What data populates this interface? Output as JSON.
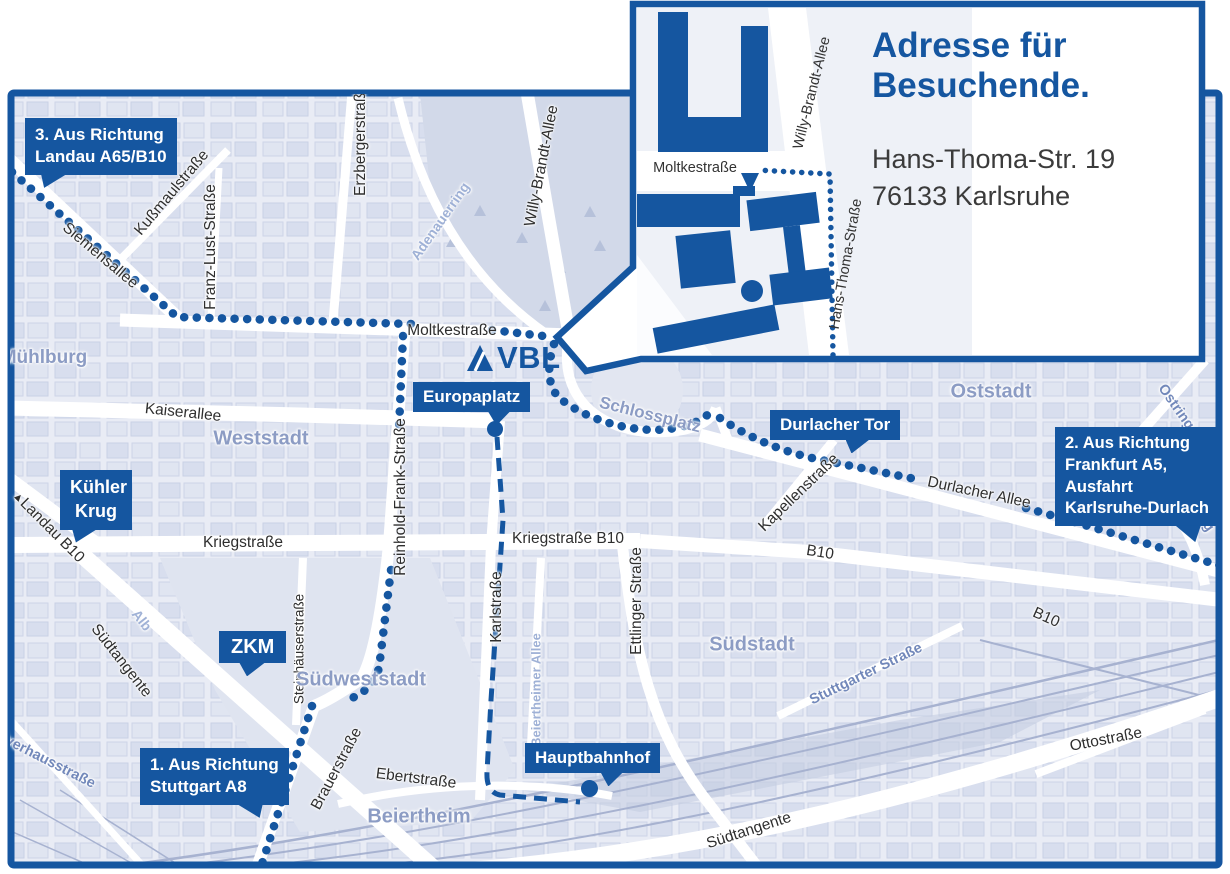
{
  "colors": {
    "brand_blue": "#1556a0",
    "map_base": "#e9ecf5",
    "area_label": "#8c9cc4",
    "water_label": "#9fb1d6"
  },
  "logo": {
    "name": "VBL"
  },
  "inset": {
    "heading_line1": "Adresse für",
    "heading_line2": "Besuchende.",
    "address_line1": "Hans-Thoma-Str. 19",
    "address_line2": "76133 Karlsruhe",
    "streets": {
      "moltkestrasse": "Moltkestraße",
      "willy_brandt_allee": "Willy-Brandt-Allee",
      "hans_thoma_strasse": "Hans-Thoma-Straße"
    }
  },
  "callouts": {
    "landau": {
      "line1": "3. Aus Richtung",
      "line2": "Landau A65/B10"
    },
    "frankfurt": {
      "line1": "2. Aus Richtung",
      "line2": "Frankfurt A5,",
      "line3": "Ausfahrt",
      "line4": "Karlsruhe-Durlach"
    },
    "stuttgart": {
      "line1": "1. Aus Richtung",
      "line2": "Stuttgart A8"
    },
    "kuehler_krug": {
      "line1": "Kühler",
      "line2": "Krug"
    },
    "zkm": {
      "label": "ZKM"
    },
    "europaplatz": {
      "label": "Europaplatz"
    },
    "durlacher_tor": {
      "label": "Durlacher Tor"
    },
    "hauptbahnhof": {
      "label": "Hauptbahnhof"
    }
  },
  "streets": {
    "siemensallee": "Siemensallee",
    "kussmaulstrasse": "Kußmaulstraße",
    "franz_lust_strasse": "Franz-Lust-Straße",
    "erzbergerstrasse": "Erzbergerstraße",
    "moltkestrasse": "Moltkestraße",
    "kaiserallee": "Kaiserallee",
    "kriegstrasse": "Kriegstraße",
    "kriegstrasse_b10": "Kriegstraße B10",
    "karlstrasse": "Karlstraße",
    "ettlinger_strasse": "Ettlinger Straße",
    "reinhold_frank_strasse": "Reinhold-Frank-Straße",
    "steinhaeuserstrasse": "Steinhäuserstraße",
    "suedtangente": "Südtangente",
    "landau_b10": "Landau B10",
    "brauerstrasse": "Brauerstraße",
    "ebertstrasse": "Ebertstraße",
    "beiertheimer_allee": "Beiertheimer Allee",
    "alb": "Alb",
    "adenauerring": "Adenauerring",
    "willy_brandt_allee": "Willy-Brandt-Allee",
    "durlacher_allee": "Durlacher Allee",
    "kapellenstrasse": "Kapellenstraße",
    "b10": "B10",
    "stuttgarter_strasse": "Stuttgarter Straße",
    "ottostrasse": "Ottostraße",
    "ostring": "Ostring",
    "pulverhausstrasse": "Pulverhausstraße"
  },
  "areas": {
    "muehlburg": "Mühlburg",
    "weststadt": "Weststadt",
    "oststadt": "Oststadt",
    "suedstadt": "Südstadt",
    "suedweststadt": "Südweststadt",
    "beiertheim": "Beiertheim",
    "schlossplatz": "Schlossplatz"
  },
  "misc": {
    "direction_arrow": "▲"
  }
}
